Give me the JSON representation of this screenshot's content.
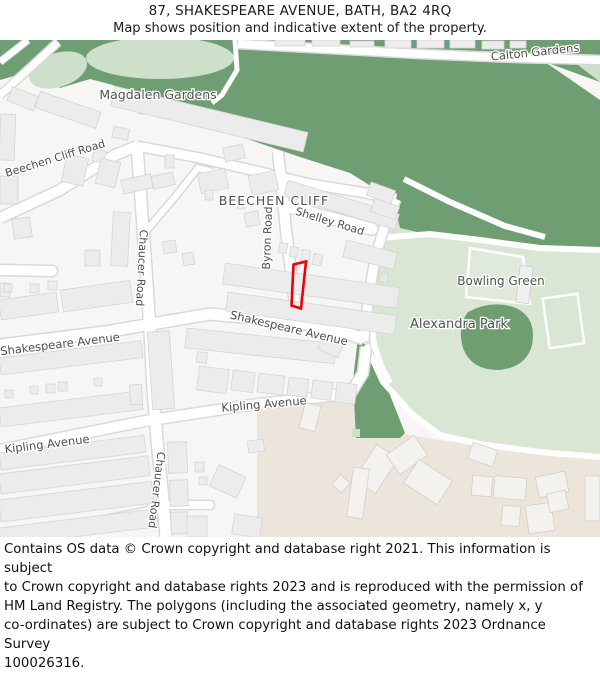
{
  "title": {
    "line1": "87, SHAKESPEARE AVENUE, BATH, BA2 4RQ",
    "line2": "Map shows position and indicative extent of the property."
  },
  "map": {
    "labels": [
      {
        "id": "calton-gardens",
        "text": "Calton Gardens"
      },
      {
        "id": "magdalen-gardens",
        "text": "Magdalen Gardens"
      },
      {
        "id": "beechen-cliff-road",
        "text": "Beechen Cliff Road"
      },
      {
        "id": "beechen-cliff",
        "text": "BEECHEN CLIFF"
      },
      {
        "id": "shelley-road",
        "text": "Shelley Road"
      },
      {
        "id": "byron-road",
        "text": "Byron Road"
      },
      {
        "id": "chaucer-road-upper",
        "text": "Chaucer Road"
      },
      {
        "id": "shakespeare-avenue-w",
        "text": "Shakespeare Avenue"
      },
      {
        "id": "shakespeare-avenue-e",
        "text": "Shakespeare Avenue"
      },
      {
        "id": "kipling-avenue-e",
        "text": "Kipling Avenue"
      },
      {
        "id": "kipling-avenue-w",
        "text": "Kipling Avenue"
      },
      {
        "id": "bowling-green",
        "text": "Bowling Green"
      },
      {
        "id": "alexandra-park",
        "text": "Alexandra Park"
      },
      {
        "id": "chaucer-road-lower",
        "text": "Chaucer Road"
      }
    ],
    "property_marker": {
      "description": "Red outline showing indicative extent of 87 Shakespeare Avenue",
      "color": "#ee0000"
    },
    "colors": {
      "map_background": "#f7f6f4",
      "green_dark": "#6f9e72",
      "green_patch": "#cde0c9",
      "park_base": "#d8e6d3",
      "beige_area": "#ece5db",
      "road_fill": "#ffffff",
      "road_casing": "#d9d9d9",
      "building_fill": "#ececec",
      "street_label": "#4e4e4e",
      "area_label": "#4b564c"
    }
  },
  "footer": {
    "lines": [
      "Contains OS data © Crown copyright and database right 2021. This information is subject",
      "to Crown copyright and database rights 2023 and is reproduced with the permission of",
      "HM Land Registry. The polygons (including the associated geometry, namely x, y",
      "co-ordinates) are subject to Crown copyright and database rights 2023 Ordnance Survey",
      "100026316."
    ]
  }
}
